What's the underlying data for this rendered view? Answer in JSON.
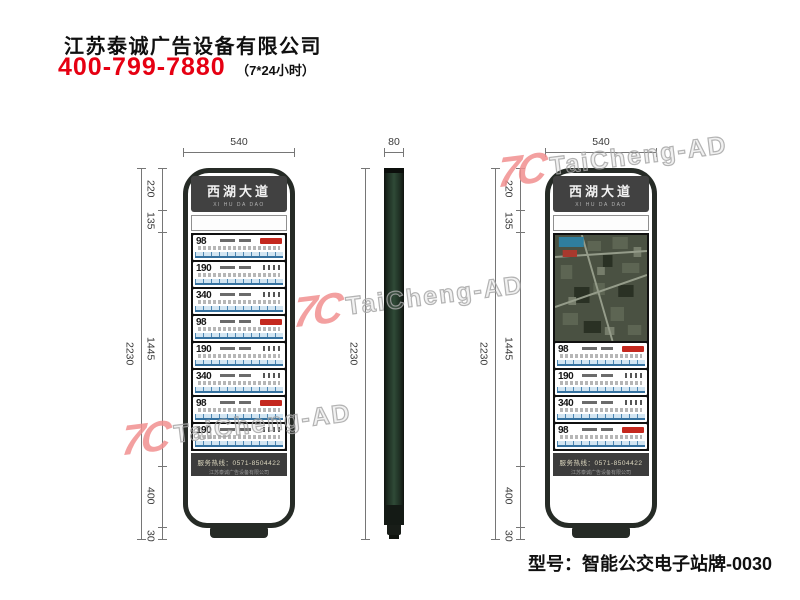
{
  "company": {
    "name": "江苏泰诚广告设备有限公司",
    "phone": "400-799-7880",
    "hours": "（7*24小时）"
  },
  "model": {
    "label": "型号：智能公交电子站牌-0030"
  },
  "watermark": {
    "logo_glyph": "7C",
    "text": "TaiCheng-AD"
  },
  "station": {
    "name": "西湖大道",
    "pinyin": "XI HU DA DAO",
    "service_line1": "服务热线：0571-8504422",
    "service_line2": "江苏泰诚广告设备有限公司"
  },
  "views": {
    "front": {
      "width": "540",
      "height": "2230",
      "segments": [
        "220",
        "135",
        "1445",
        "400",
        "30"
      ],
      "routes": [
        "98",
        "190",
        "340",
        "98",
        "190",
        "340",
        "98",
        "190"
      ]
    },
    "side": {
      "width": "80",
      "height": "2230"
    },
    "front_map": {
      "width": "540",
      "height": "2230",
      "segments": [
        "220",
        "135",
        "1445",
        "400",
        "30"
      ],
      "routes": [
        "98",
        "190",
        "340",
        "98"
      ]
    }
  },
  "colors": {
    "accent_red": "#e60012",
    "frame_dark": "#262b26",
    "watermark_pink": "#f19090",
    "route_line_blue": "#35719f"
  }
}
